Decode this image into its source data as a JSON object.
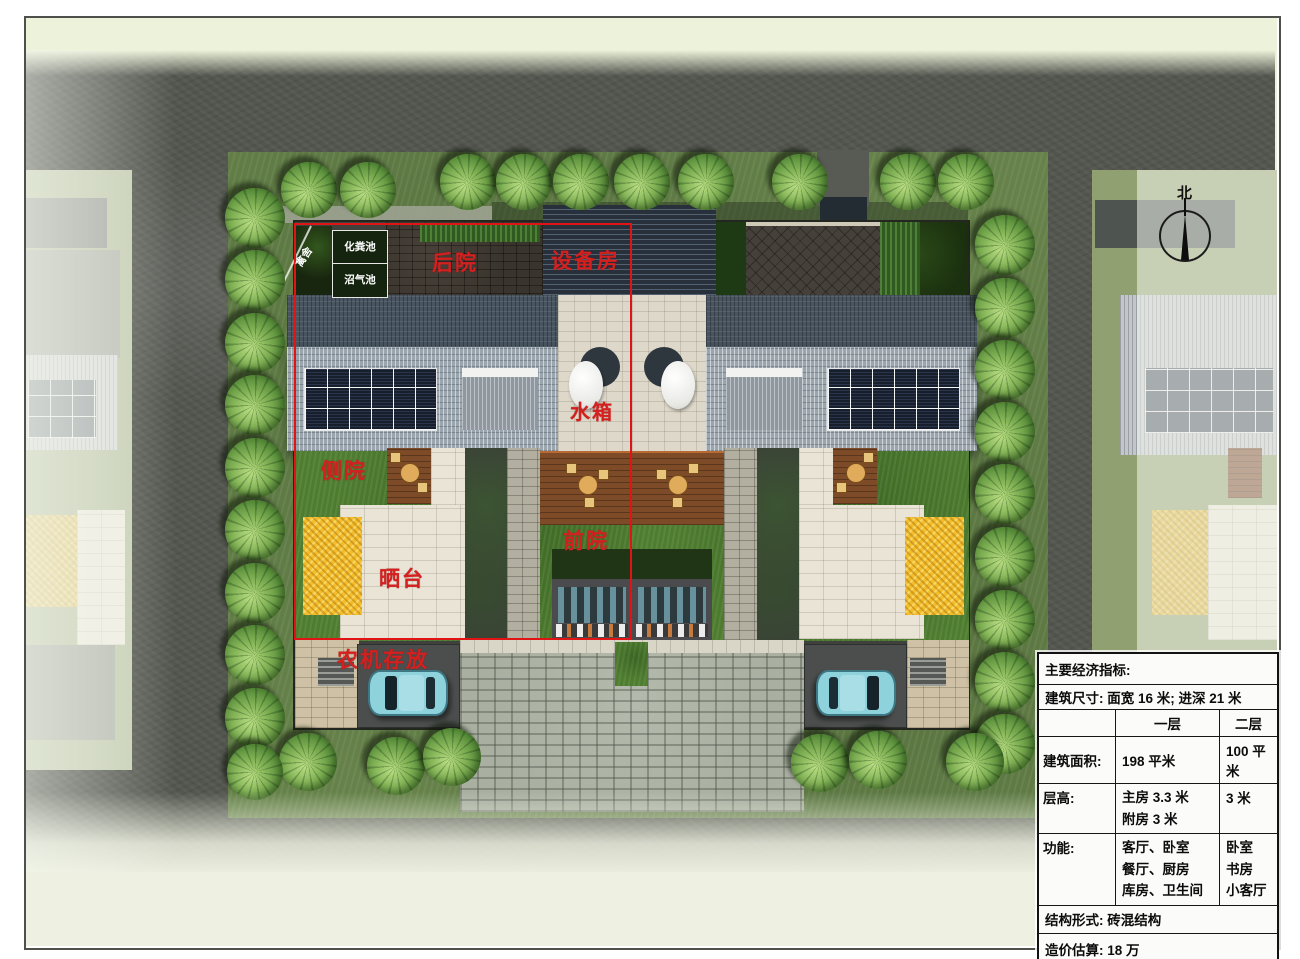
{
  "annotations": {
    "poultry_shed": "禽舍",
    "septic_tank": "化粪池",
    "biogas_tank": "沼气池",
    "back_yard": "后院",
    "equipment_room": "设备房",
    "water_tank": "水箱",
    "side_yard": "侧院",
    "drying_terrace": "晒台",
    "front_yard": "前院",
    "machinery_storage": "农机存放",
    "north": "北"
  },
  "table": {
    "title": "主要经济指标:",
    "dimensions": "建筑尺寸: 面宽 16 米; 进深 21 米",
    "col_headers": [
      "一层",
      "二层"
    ],
    "rows": [
      {
        "label": "建筑面积:",
        "f1": [
          "198 平米"
        ],
        "f2": [
          "100 平米"
        ]
      },
      {
        "label": "层高:",
        "f1": [
          "主房 3.3 米",
          "附房 3 米"
        ],
        "f2": [
          "3 米"
        ]
      },
      {
        "label": "功能:",
        "f1": [
          "客厅、卧室",
          "餐厅、厨房",
          "库房、卫生间"
        ],
        "f2": [
          "卧室",
          "书房",
          "小客厅"
        ]
      }
    ],
    "structure": "结构形式: 砖混结构",
    "cost": "造价估算: 18 万"
  },
  "colors": {
    "annotation_red": "#d52020",
    "highlight_box_red": "#e01414",
    "road_grey": "#53564f",
    "perimeter_grass": "#66824a",
    "courtyard_grass": "#4e7d2f",
    "grain_yellow": "#f4be2b",
    "solar_panel_dark": "#171f2d",
    "roof_light": "#9aa5ae",
    "car_blue": "#8ed2dc"
  }
}
